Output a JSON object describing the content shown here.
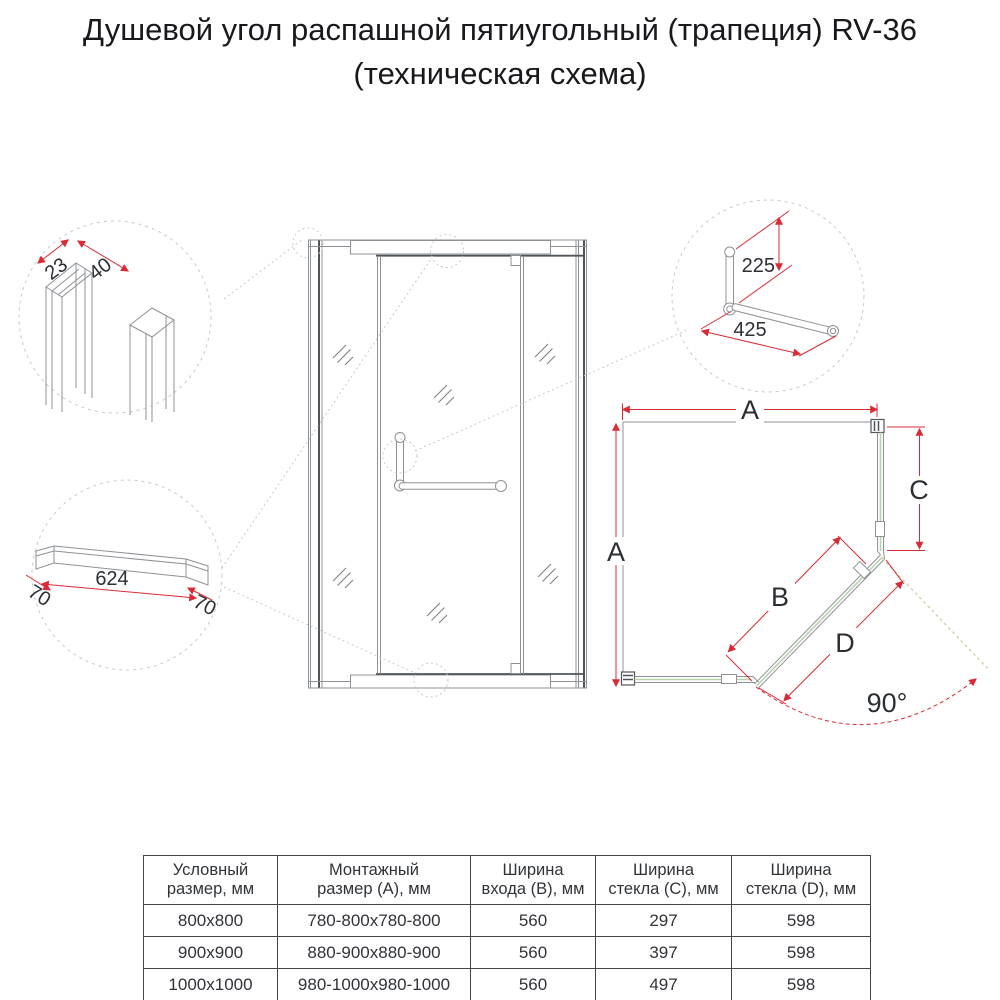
{
  "title": {
    "line1": "Душевой угол распашной пятиугольный (трапеция) RV-36",
    "line2": "(техническая схема)"
  },
  "details": {
    "profile": {
      "dim_width": "23",
      "dim_depth": "40"
    },
    "threshold": {
      "dim_left": "70",
      "dim_length": "624",
      "dim_right": "70"
    },
    "handle": {
      "dim_height": "225",
      "dim_length": "425"
    }
  },
  "plan": {
    "dim_width_top": "A",
    "dim_depth_left": "A",
    "dim_glass_right": "C",
    "dim_entrance": "B",
    "dim_door": "D",
    "door_angle": "90°"
  },
  "table": {
    "headers": [
      "Условный\nразмер, мм",
      "Монтажный\nразмер (А), мм",
      "Ширина\nвхода (B), мм",
      "Ширина\nстекла (C), мм",
      "Ширина\nстекла (D), мм"
    ],
    "rows": [
      [
        "800x800",
        "780-800x780-800",
        "560",
        "297",
        "598"
      ],
      [
        "900x900",
        "880-900x880-900",
        "560",
        "397",
        "598"
      ],
      [
        "1000x1000",
        "980-1000x980-1000",
        "560",
        "497",
        "598"
      ]
    ]
  },
  "colors": {
    "dimension_red": "#d92b35",
    "glass_green": "#b9d2ae",
    "open_door_dash": "#cdd0a4",
    "drawing_gray": "#8d9196",
    "drawing_dark": "#4f545a",
    "leader_gray": "#c6c9cb",
    "table_border": "#43474c",
    "text": "#2b2f33"
  }
}
